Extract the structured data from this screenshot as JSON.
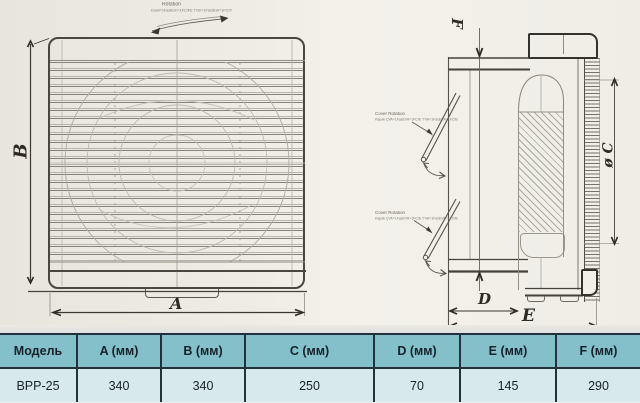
{
  "drawing": {
    "front_view": {
      "dim_a_label": "A",
      "dim_b_label": "B",
      "rotation_title": "Rotation",
      "rotation_note": "Dush=1FastExh=1FC/FE T'ish=1FastExh=1FC/X"
    },
    "side_view": {
      "dim_f_label": "F",
      "dim_d_label": "D",
      "dim_e_label": "E",
      "dim_c_label": "ø C",
      "cover_rotation_1": {
        "title": "Cover Rotation",
        "note": "Kapak ÇVA=1FasEVA=1FC/E T'VA=1FasEVA=1FC/B"
      },
      "cover_rotation_2": {
        "title": "Cover Rotation",
        "note": "Kapak ÇVA=1FasEVA=1FC/E T'VA=1FasEVA=1FC/B"
      }
    }
  },
  "table": {
    "headers": [
      "Модель",
      "A (мм)",
      "B (мм)",
      "C (мм)",
      "D (мм)",
      "E (мм)",
      "F (мм)"
    ],
    "rows": [
      [
        "ВРР-25",
        "340",
        "340",
        "250",
        "70",
        "145",
        "290"
      ]
    ]
  },
  "colors": {
    "paper": "#efede5",
    "ink_dark": "#35322b",
    "ink_faint": "#b3afa4",
    "table_header_bg": "#84c0c9",
    "table_row_bg": "#d7e9ec",
    "table_border": "#22313a"
  }
}
